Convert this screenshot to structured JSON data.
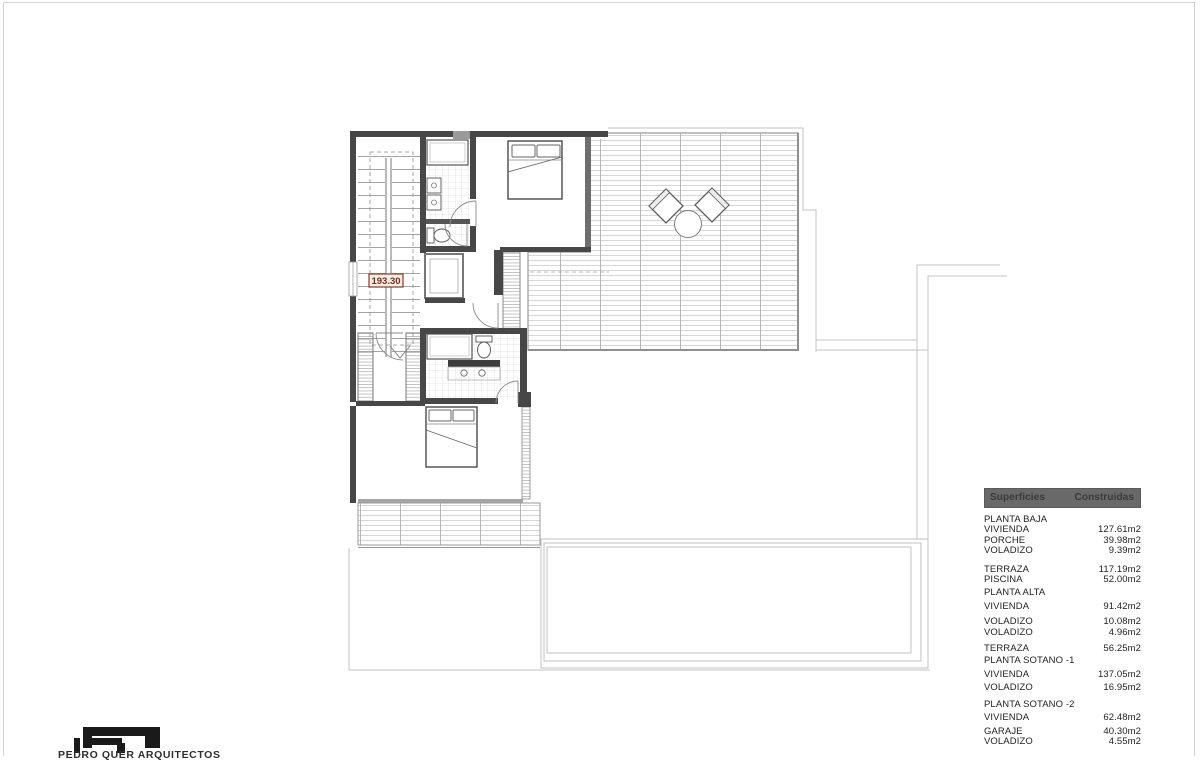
{
  "page": {
    "background": "#ffffff",
    "frame_color": "#d4d4d4",
    "accent_red": "#8a3a2a",
    "table_header_bg": "#696969",
    "wall_color": "#474747"
  },
  "plan": {
    "area_label": "193.30"
  },
  "areas_table": {
    "header": {
      "col1": "Superficies",
      "col2": "Construidas"
    },
    "rows": [
      {
        "label": "PLANTA BAJA",
        "value": ""
      },
      {
        "label": "VIVIENDA",
        "value": "127.61m2"
      },
      {
        "label": "PORCHE",
        "value": "39.98m2"
      },
      {
        "label": "VOLADIZO",
        "value": "9.39m2"
      },
      {
        "label": "TERRAZA",
        "value": "117.19m2"
      },
      {
        "label": "PISCINA",
        "value": "52.00m2"
      },
      {
        "label": "PLANTA ALTA",
        "value": ""
      },
      {
        "label": "VIVIENDA",
        "value": "91.42m2"
      },
      {
        "label": "VOLADIZO",
        "value": "10.08m2"
      },
      {
        "label": "VOLADIZO",
        "value": "4.96m2"
      },
      {
        "label": "TERRAZA",
        "value": "56.25m2"
      },
      {
        "label": "PLANTA SOTANO -1",
        "value": ""
      },
      {
        "label": "VIVIENDA",
        "value": "137.05m2"
      },
      {
        "label": "VOLADIZO",
        "value": "16.95m2"
      },
      {
        "label": "PLANTA SOTANO -2",
        "value": ""
      },
      {
        "label": "VIVIENDA",
        "value": "62.48m2"
      },
      {
        "label": "GARAJE",
        "value": "40.30m2"
      },
      {
        "label": "VOLADIZO",
        "value": "4.55m2"
      }
    ]
  },
  "logo": {
    "text": "PEDRO QUER ARQUITECTOS"
  }
}
